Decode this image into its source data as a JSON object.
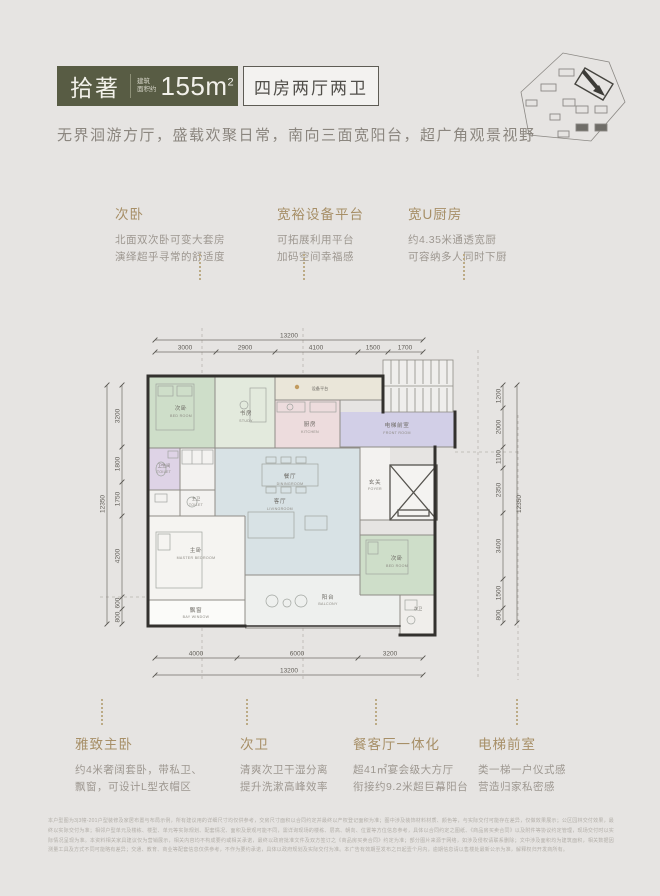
{
  "header": {
    "brand": "拾著",
    "area_label_l1": "建筑",
    "area_label_l2": "面积约",
    "area_value": "155m",
    "area_sup": "2",
    "layout_label": "四房两厅两卫"
  },
  "tagline": "无界洄游方厅，盛载欢聚日常，南向三面宽阳台，超广角观景视野",
  "features_top": [
    {
      "title": "次卧",
      "lines": [
        "北面双次卧可变大套房",
        "演绎超乎寻常的舒适度"
      ]
    },
    {
      "title": "宽裕设备平台",
      "lines": [
        "可拓展利用平台",
        "加码空间幸福感"
      ]
    },
    {
      "title": "宽U厨房",
      "lines": [
        "约4.35米通透宽厨",
        "可容纳多人同时下厨"
      ]
    }
  ],
  "features_bottom": [
    {
      "title": "雅致主卧",
      "lines": [
        "约4米奢阔套卧，带私卫、",
        "飘窗，可设计L型衣帽区"
      ]
    },
    {
      "title": "次卫",
      "lines": [
        "清爽次卫干湿分离",
        "提升洗漱高峰效率"
      ]
    },
    {
      "title": "餐客厅一体化",
      "lines": [
        "超41㎡宴会级大方厅",
        "衔接约9.2米超巨幕阳台"
      ]
    },
    {
      "title": "电梯前室",
      "lines": [
        "类一梯一户仪式感",
        "营造归家私密感"
      ]
    }
  ],
  "floorplan": {
    "dims": {
      "top": {
        "total": "13200",
        "segments": [
          "3000",
          "2900",
          "4100",
          "1500",
          "1700"
        ]
      },
      "bottom": {
        "total": "13200",
        "segments": [
          "4000",
          "6000",
          "3200"
        ]
      },
      "left": {
        "total": "12350",
        "segments": [
          "3200",
          "1800",
          "1750",
          "4200",
          "600",
          "800"
        ]
      },
      "right": {
        "total": "12350",
        "segments": [
          "1200",
          "2000",
          "1100",
          "2350",
          "3400",
          "1500",
          "800"
        ]
      }
    },
    "rooms": {
      "bed1": {
        "cn": "次卧",
        "en": "BED ROOM"
      },
      "study": {
        "cn": "书房",
        "en": "STUDY"
      },
      "equip": {
        "cn": "设备平台"
      },
      "kitchen": {
        "cn": "厨房",
        "en": "KITCHEN"
      },
      "front": {
        "cn": "电梯前室",
        "en": "FRONT ROOM"
      },
      "foyer": {
        "cn": "玄关",
        "en": "FOYER"
      },
      "dining": {
        "cn": "餐厅",
        "en": "DININGROOM"
      },
      "living": {
        "cn": "客厅",
        "en": "LIVINGROOM"
      },
      "toilet1": {
        "cn": "卫生间",
        "en": "TOILET"
      },
      "mtoilet": {
        "cn": "主卫",
        "en": "TOILET"
      },
      "master": {
        "cn": "主卧",
        "en": "MASTER BEDROOM"
      },
      "bay": {
        "cn": "飘窗",
        "en": "BAY WINDOW"
      },
      "balcony": {
        "cn": "阳台",
        "en": "BALCONY"
      },
      "bed2": {
        "cn": "次卧",
        "en": "BED ROOM"
      },
      "bath2": {
        "cn": "次卫"
      }
    }
  },
  "disclaimer": "本户型图为3|3幢-201户型装修及家居布置与布局示例，所有建议用的详细尺寸均仅供参考，交房尺寸面积以合同约定并最终以产权登记面积为准；图中涉及装饰材料材质、颜色等，与实际交付可能存在差异，仅做效果展示；公区园林交付效果，最终以实际交付为准；相邻户型单元及楼栋、楼型、单元等实际规划、配套情况、面积及景观可能不同，需详询现场的楼栋、层高、朝向、位置等方位信息参考，具体以合同约定之图纸、《商品房买卖合同》以及附件等协议约定管理，现场交付时以实际情况呈现为准。本资料相关家具建议仅为营销展示，相关内容均不构成要约或相关承诺，最终以政府批准文件及双方签订之《商品房买卖合同》约定为准；部分图片来源于网络，如涉及侵权请联系删除；文中涉及面积均为建筑面积，相关数据因测量工具及方式不同可能略有差异；交通、教育、商业等配套信息仅供参考，不作为要约承诺，具体以政府规划及实际交付为准。本广告有效期至发布之日起壹个月内，逾期信息请以售楼处最新公示为准，解释权归开发商所有。"
}
